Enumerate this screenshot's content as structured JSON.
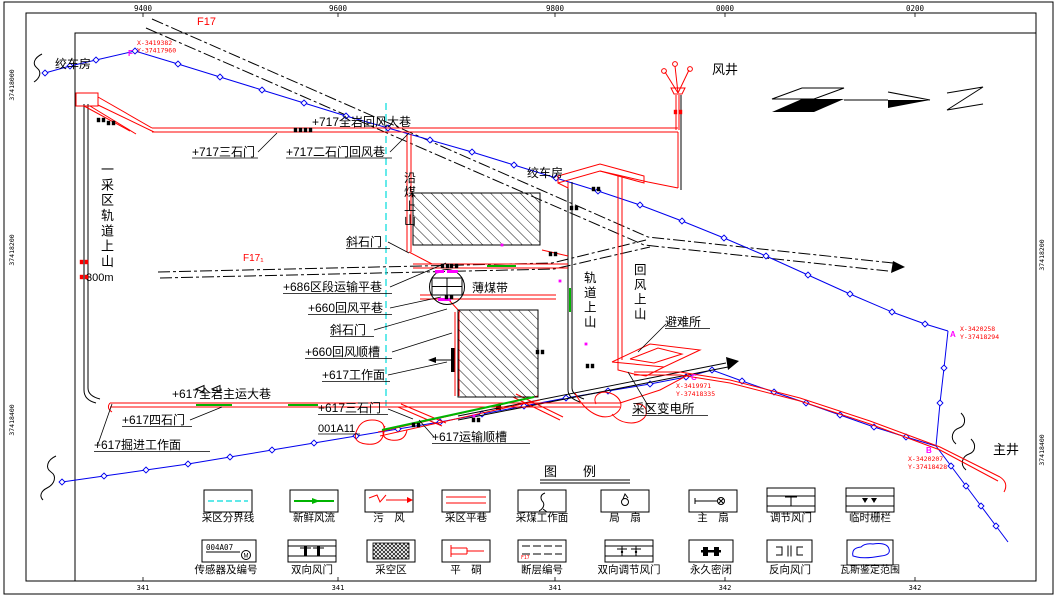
{
  "frame": {
    "top_ticks": [
      "9400",
      "9600",
      "9800",
      "0000",
      "0200"
    ],
    "bottom_ticks": [
      "341",
      "341",
      "341",
      "342",
      "342"
    ],
    "left_ticks": [
      "37418000",
      "37418200",
      "37418400"
    ],
    "right_ticks": [
      "37418200",
      "37418400"
    ]
  },
  "points": {
    "f": {
      "letter": "F",
      "x": "X-3419382",
      "y": "Y-37417960"
    },
    "a": {
      "letter": "A",
      "x": "X-3420258",
      "y": "Y-37418294"
    },
    "c": {
      "letter": "C",
      "x": "X-3419971",
      "y": "Y-37418335"
    },
    "b": {
      "letter": "B",
      "x": "X-3420207",
      "y": "Y-37418428"
    }
  },
  "labels": {
    "winch_house_top": "绞车房",
    "winch_house_center": "绞车房",
    "air_shaft": "风井",
    "main_shaft": "主井",
    "fault_f17": "F17",
    "fault_f17_1": "F17₁",
    "return_main_717": "+717全岩回风大巷",
    "crosscut3_717": "+717三石门",
    "crosscut2_return_717": "+717二石门回风巷",
    "coal_incline": "沿煤上山",
    "incline_crosscut_upper": "斜石门",
    "transport_level_686": "+686区段运输平巷",
    "thin_coal_belt": "薄煤带",
    "return_level_660": "+660回风平巷",
    "incline_crosscut_lower": "斜石门",
    "return_gateway_660": "+660回风顺槽",
    "working_face_617": "+617工作面",
    "main_haulage_617": "+617全岩主运大巷",
    "crosscut3_617": "+617三石门",
    "panel_id": "001A11",
    "crosscut4_617": "+617四石门",
    "heading_face_617": "+617掘进工作面",
    "transport_gateway_617": "+617运输顺槽",
    "substation": "采区变电所",
    "refuge_chamber": "避难所",
    "rail_incline_center": "轨道上山",
    "return_incline": "回风上山",
    "district1_rail_incline": "一采区轨道上山",
    "incline_length": "300m"
  },
  "legend": {
    "title": "图　　例",
    "items": [
      "采区分界线",
      "新鲜风流",
      "污　风",
      "采区平巷",
      "采煤工作面",
      "局　扇",
      "主　扇",
      "调节风门",
      "临时栅栏",
      "传感器及编号",
      "双向风门",
      "采空区",
      "平　硐",
      "断层编号",
      "双向调节风门",
      "永久密闭",
      "反向风门",
      "瓦斯鉴定范围"
    ],
    "sensor_code": "004A07",
    "sensor_letter": "M",
    "fault_code": "F17"
  },
  "colors": {
    "roadway": "#ff0000",
    "survey_line": "#0000ee",
    "district_boundary": "#00dcdc",
    "fresh_air": "#00b400",
    "marker": "#ff00ff"
  }
}
